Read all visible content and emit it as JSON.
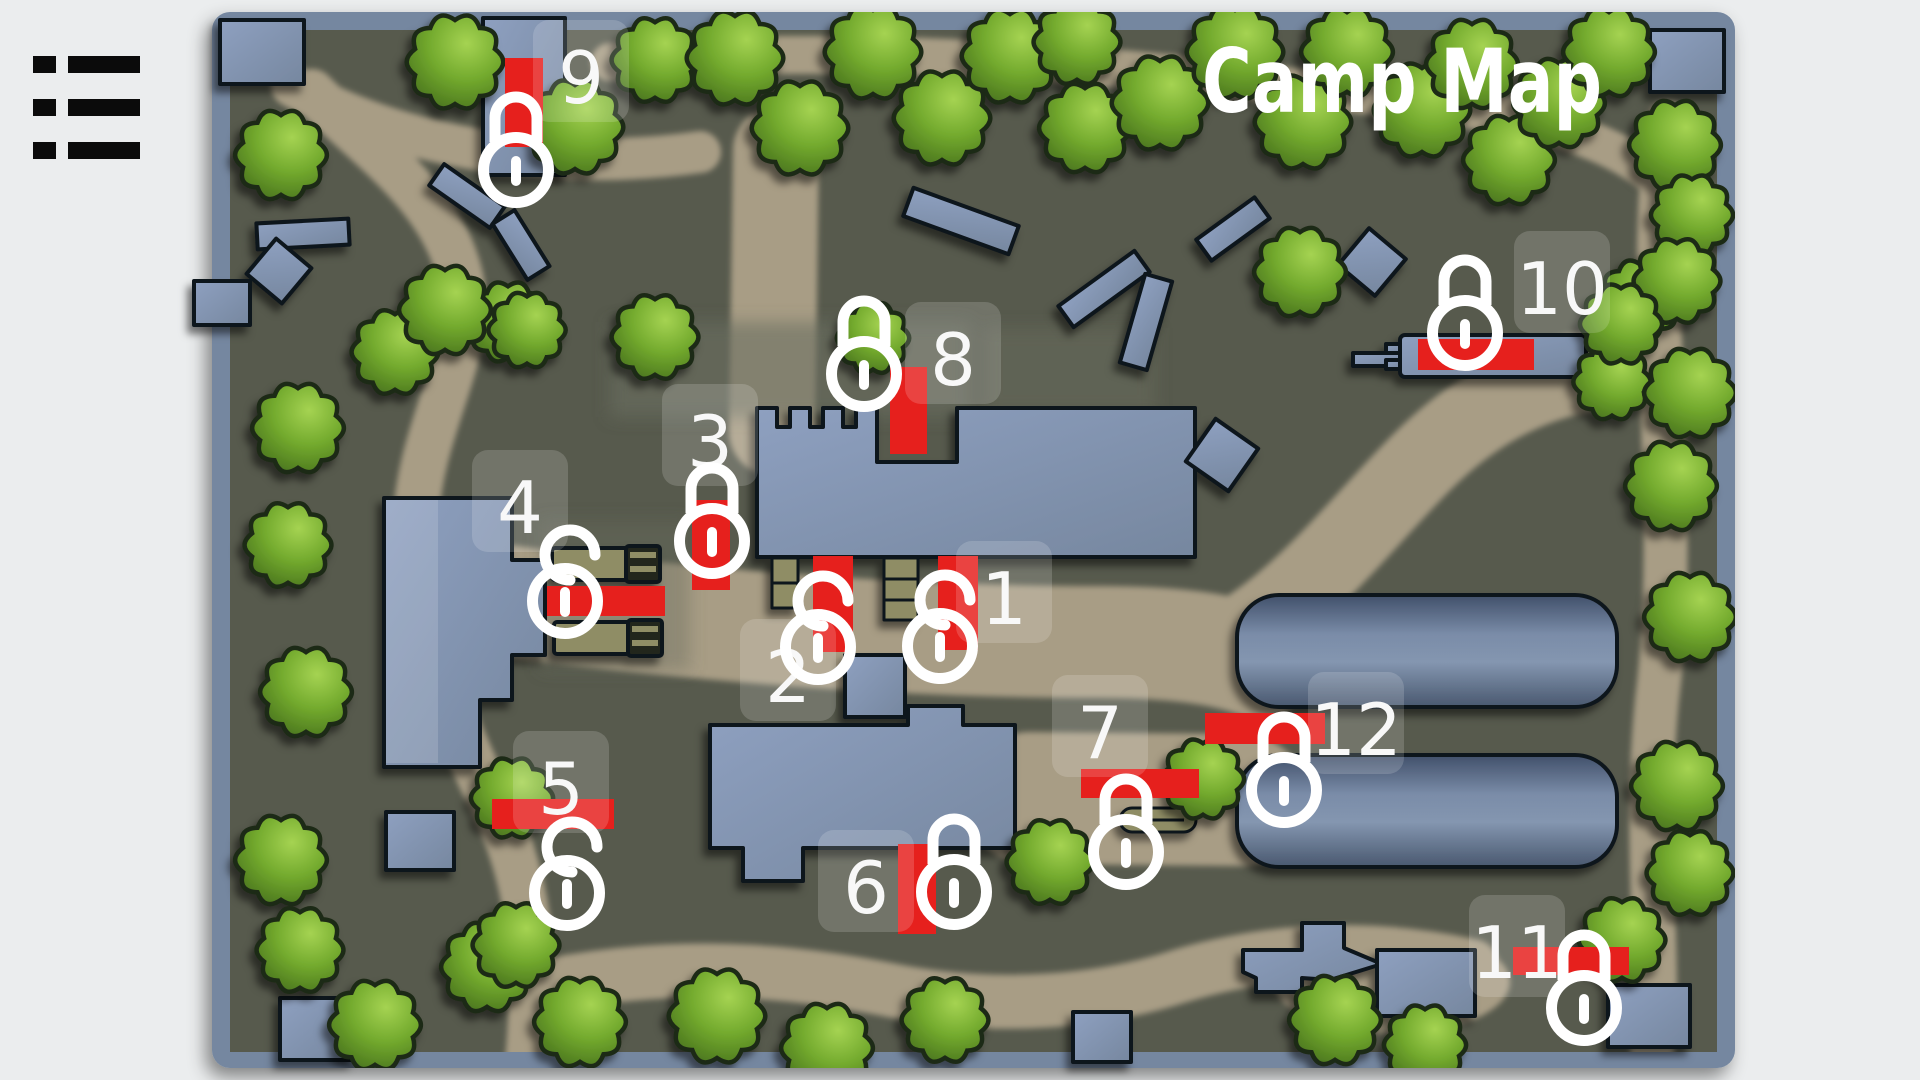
{
  "menu": {
    "icon": "list-menu-icon"
  },
  "map": {
    "title": "Camp Map",
    "colors": {
      "zone": "#e6201d",
      "lock": "#ffffff",
      "label_text": "#f8f8f8",
      "label_bg": "rgba(255,255,255,0.16)"
    },
    "markers": [
      {
        "id": "1",
        "label": "1",
        "state": "unlocked",
        "zone": {
          "x": 938,
          "y": 556,
          "w": 40,
          "h": 94
        },
        "lock": {
          "x": 940,
          "y": 646
        },
        "num": {
          "x": 1004,
          "y": 597
        }
      },
      {
        "id": "2",
        "label": "2",
        "state": "unlocked",
        "zone": {
          "x": 813,
          "y": 556,
          "w": 40,
          "h": 96
        },
        "lock": {
          "x": 818,
          "y": 647
        },
        "num": {
          "x": 788,
          "y": 675
        }
      },
      {
        "id": "3",
        "label": "3",
        "state": "locked",
        "zone": {
          "x": 692,
          "y": 500,
          "w": 38,
          "h": 90
        },
        "lock": {
          "x": 712,
          "y": 541
        },
        "num": {
          "x": 710,
          "y": 440
        }
      },
      {
        "id": "4",
        "label": "4",
        "state": "unlocked",
        "zone": {
          "x": 547,
          "y": 586,
          "w": 118,
          "h": 30
        },
        "lock": {
          "x": 565,
          "y": 601
        },
        "num": {
          "x": 520,
          "y": 506
        }
      },
      {
        "id": "5",
        "label": "5",
        "state": "unlocked",
        "zone": {
          "x": 492,
          "y": 799,
          "w": 122,
          "h": 30
        },
        "lock": {
          "x": 567,
          "y": 893
        },
        "num": {
          "x": 561,
          "y": 787
        }
      },
      {
        "id": "6",
        "label": "6",
        "state": "locked",
        "zone": {
          "x": 898,
          "y": 844,
          "w": 38,
          "h": 90
        },
        "lock": {
          "x": 954,
          "y": 892
        },
        "num": {
          "x": 866,
          "y": 886
        }
      },
      {
        "id": "7",
        "label": "7",
        "state": "locked",
        "zone": {
          "x": 1081,
          "y": 769,
          "w": 118,
          "h": 29
        },
        "lock": {
          "x": 1126,
          "y": 852
        },
        "num": {
          "x": 1100,
          "y": 731
        }
      },
      {
        "id": "8",
        "label": "8",
        "state": "locked",
        "zone": {
          "x": 890,
          "y": 367,
          "w": 37,
          "h": 87
        },
        "lock": {
          "x": 864,
          "y": 374
        },
        "num": {
          "x": 953,
          "y": 358
        }
      },
      {
        "id": "9",
        "label": "9",
        "state": "locked",
        "zone": {
          "x": 505,
          "y": 58,
          "w": 38,
          "h": 89
        },
        "lock": {
          "x": 516,
          "y": 170
        },
        "num": {
          "x": 581,
          "y": 76
        }
      },
      {
        "id": "10",
        "label": "10",
        "state": "locked",
        "zone": {
          "x": 1418,
          "y": 339,
          "w": 116,
          "h": 31
        },
        "lock": {
          "x": 1465,
          "y": 333
        },
        "num": {
          "x": 1562,
          "y": 287
        }
      },
      {
        "id": "11",
        "label": "11",
        "state": "locked",
        "zone": {
          "x": 1513,
          "y": 947,
          "w": 116,
          "h": 28
        },
        "lock": {
          "x": 1584,
          "y": 1008
        },
        "num": {
          "x": 1517,
          "y": 951
        }
      },
      {
        "id": "12",
        "label": "12",
        "state": "locked",
        "zone": {
          "x": 1205,
          "y": 713,
          "w": 120,
          "h": 31
        },
        "lock": {
          "x": 1284,
          "y": 790
        },
        "num": {
          "x": 1356,
          "y": 728
        }
      }
    ]
  }
}
